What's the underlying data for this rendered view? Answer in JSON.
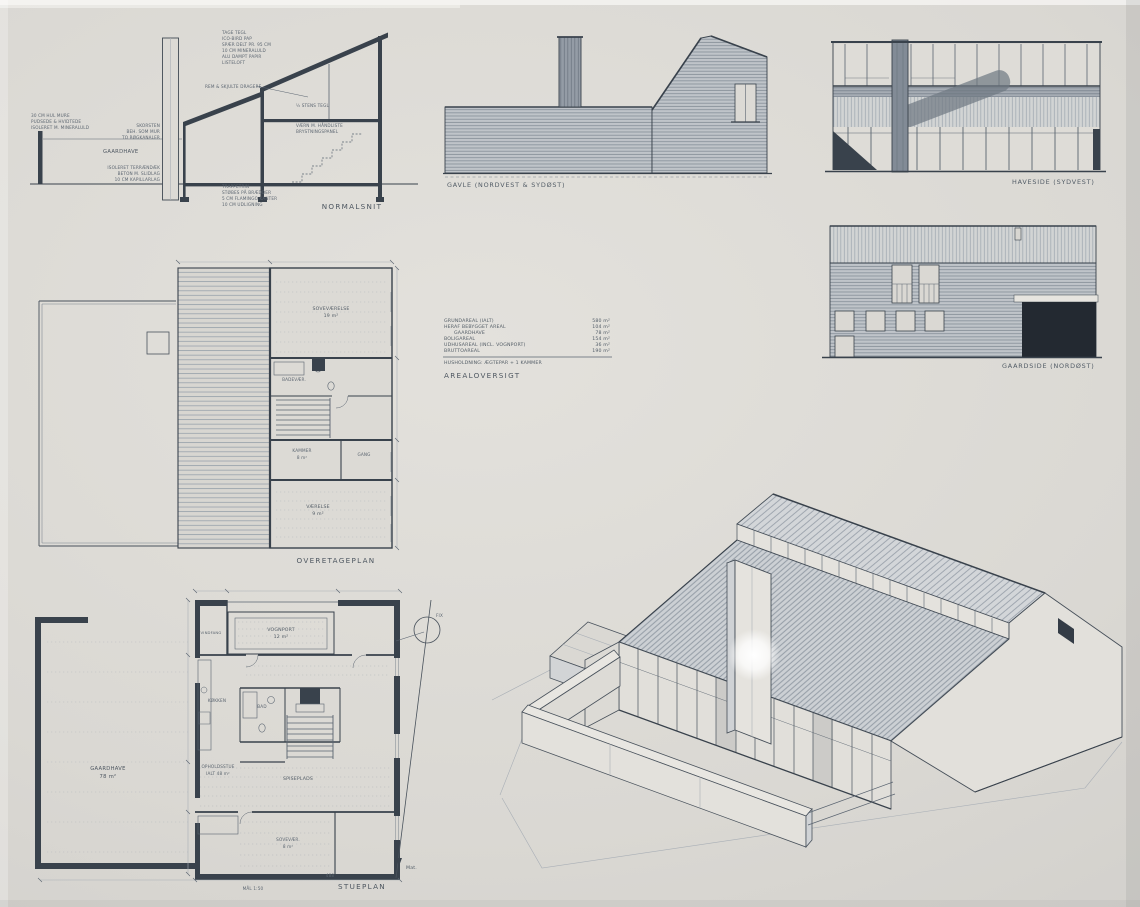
{
  "labels": {
    "normalsnit": "NORMALSNIT",
    "gavle": "GAVLE  (NORDVEST & SYDØST)",
    "haveside": "HAVESIDE  (SYDVEST)",
    "gaardside": "GAARDSIDE  (NORDØST)",
    "overetageplan": "OVERETAGEPLAN",
    "stueplan": "STUEPLAN",
    "arealoversigt": "AREALOVERSIGT"
  },
  "section": {
    "roof_note": [
      "TAGE TEGL",
      "ICO-BIRD PAP",
      "SPÆR DELT PR. 95 CM",
      "10 CM MINERALULD",
      "ALU DAMPT PAPIR",
      "LISTELOFT"
    ],
    "beam_note": "REM & SKJULTE DRAGERE",
    "wall_note": "½ STENS TEGL",
    "parapet_note": [
      "VÆRN M. HÅNDLISTE",
      "BRYSTNINGSPANEL"
    ],
    "left_wall_note": [
      "30 CM HUL MURE",
      "PUDSEDE & HVIDTEDE",
      "ISOLERET M. MINERALULD"
    ],
    "gaardhave_label": "GAARDHAVE",
    "chimney_note": [
      "SKORSTEN",
      "BEH. SOM MUR",
      "TO RØGKANALER"
    ],
    "floor_note": [
      "ISOLERET TERRÆNDÆK",
      "BETON M. SLIDLAG",
      "10 CM KAPILLARLAG"
    ],
    "stair_note": [
      "TRAPPETRIN",
      "STØBES PÅ BRÆDDER",
      "5 CM FLAMINGO KANTER",
      "10 CM UDLIGNING"
    ]
  },
  "areas": {
    "rows": [
      {
        "name": "GRUNDAREAL (IALT)",
        "value": "580 m²"
      },
      {
        "name": "HERAF BEBYGGET AREAL",
        "value": "104 m²"
      },
      {
        "name": "GAARDHAVE",
        "value": "78 m²"
      },
      {
        "name": "BOLIGAREAL",
        "value": "154 m²"
      },
      {
        "name": "UDHUSAREAL (INCL. VOGNPORT)",
        "value": "36 m²"
      },
      {
        "name": "BRUTTOAREAL",
        "value": "190 m²"
      }
    ],
    "note": "HUSHOLDNING: ÆGTEPAR + 1 KAMMER"
  },
  "upper_plan": {
    "sovevaerelse": {
      "name": "SOVEVÆRELSE",
      "area": "19 m²"
    },
    "badevaerelse": {
      "name": "BADEVÆR."
    },
    "kammer": {
      "name": "KAMMER",
      "area": "8 m²"
    },
    "gang": {
      "name": "GANG"
    },
    "vaerelse": {
      "name": "VÆRELSE",
      "area": "9 m²"
    }
  },
  "ground_plan": {
    "gaardhave": {
      "name": "GAARDHAVE",
      "area": "78 m²"
    },
    "vognport": {
      "name": "VOGNPORT",
      "area": "12 m²"
    },
    "vindfang": {
      "name": "VINDFANG"
    },
    "bad": {
      "name": "BAD"
    },
    "koekken": {
      "name": "KØKKEN"
    },
    "spiseplads": {
      "name": "SPISEPLADS"
    },
    "opholdsstue": {
      "name": "OPHOLDSSTUE",
      "area": "IALT 48 m²"
    },
    "sovevaer": {
      "name": "SOVEVÆR.",
      "area": "8 m²"
    },
    "dim_total": "488",
    "scale_note": "MÅL 1:50",
    "fix_label": "FIX",
    "mat_label": "Mat."
  }
}
